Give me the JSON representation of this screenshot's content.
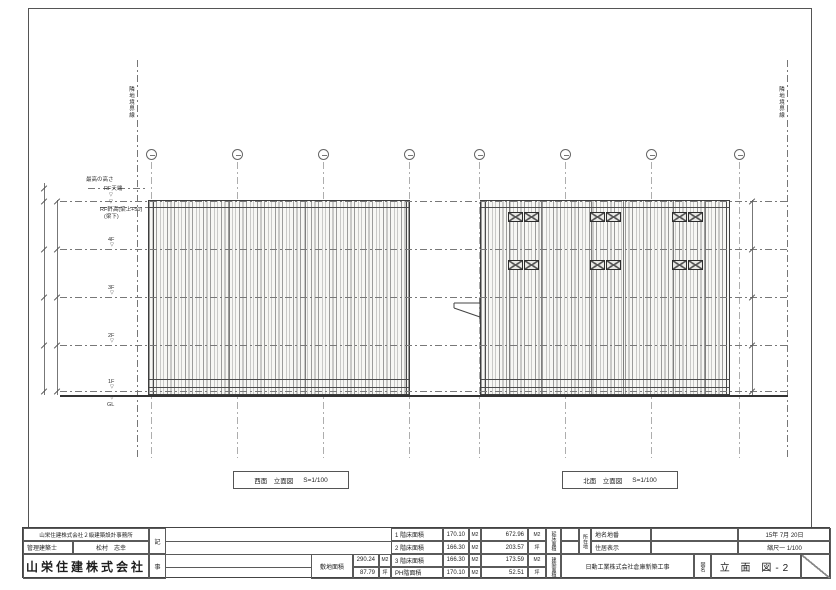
{
  "boundaries": {
    "left_label": "隣地境界線",
    "right_label": "隣地境界線"
  },
  "levels": [
    {
      "label": "最高の高さ"
    },
    {
      "label": "RF天端"
    },
    {
      "label": "RF軒高(梁上+50)",
      "label2": "(梁下)"
    },
    {
      "label": "4F"
    },
    {
      "label": "3F"
    },
    {
      "label": "2F"
    },
    {
      "label": "1F"
    },
    {
      "label": "GL"
    }
  ],
  "captions": {
    "west": {
      "title": "西面　立面図",
      "scale": "S=1/100"
    },
    "north": {
      "title": "北面　立面図",
      "scale": "S=1/100"
    }
  },
  "title_block": {
    "office": "山栄住建株式会社２級建築設計事務所",
    "architect_label": "管理建築士",
    "architect_name": "松村　志幸",
    "company": "山栄住建株式会社",
    "notes": {
      "ki": "記",
      "ji": "事"
    },
    "site_area": {
      "label": "敷地面積",
      "m2": "290.24",
      "m2_unit": "M2",
      "tsubo": "87.79",
      "tsubo_unit": "坪"
    },
    "floor_areas": [
      {
        "label": "1 階床面積",
        "value": "170.10",
        "unit": "M2"
      },
      {
        "label": "2 階床面積",
        "value": "166.30",
        "unit": "M2"
      },
      {
        "label": "3 階床面積",
        "value": "166.30",
        "unit": "M2"
      },
      {
        "label": "PH階面積",
        "value": "170.10",
        "unit": "M2"
      }
    ],
    "totals": [
      {
        "value": "672.96",
        "unit": "M2"
      },
      {
        "value": "203.57",
        "unit": "坪"
      },
      {
        "value": "173.59",
        "unit": "M2"
      },
      {
        "value": "52.51",
        "unit": "坪"
      }
    ],
    "vertical_labels": {
      "total": "延床面積",
      "building": "建築面積",
      "location": "所在地"
    },
    "address": [
      {
        "label": "地名地番"
      },
      {
        "label": "住居表示"
      }
    ],
    "project_name": "日動工業株式会社倉庫新築工事",
    "drawing_name_label": "図名",
    "drawing_name": "立 面 図-2",
    "date": "15年 7月 20日",
    "scale": "縮尺一 1/100"
  }
}
